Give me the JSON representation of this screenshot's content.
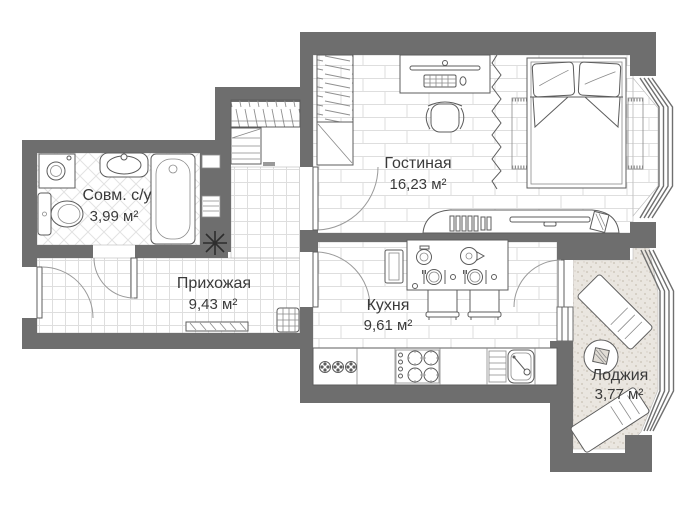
{
  "plan": {
    "title": "apartment-floor-plan",
    "rooms": [
      {
        "key": "bathroom",
        "name": "Совм. с/у",
        "area": "3,99 м²"
      },
      {
        "key": "hallway",
        "name": "Прихожая",
        "area": "9,43 м²"
      },
      {
        "key": "living",
        "name": "Гостиная",
        "area": "16,23 м²"
      },
      {
        "key": "kitchen",
        "name": "Кухня",
        "area": "9,61 м²"
      },
      {
        "key": "loggia",
        "name": "Лоджия",
        "area": "3,77 м²"
      }
    ],
    "colors": {
      "wall": "#6e6e6e",
      "furniture_line": "#5c5c5c",
      "floor_tile_line": "#dedede",
      "loggia_floor": "#eae6e0",
      "text": "#3a3a3a",
      "background": "#ffffff"
    }
  }
}
